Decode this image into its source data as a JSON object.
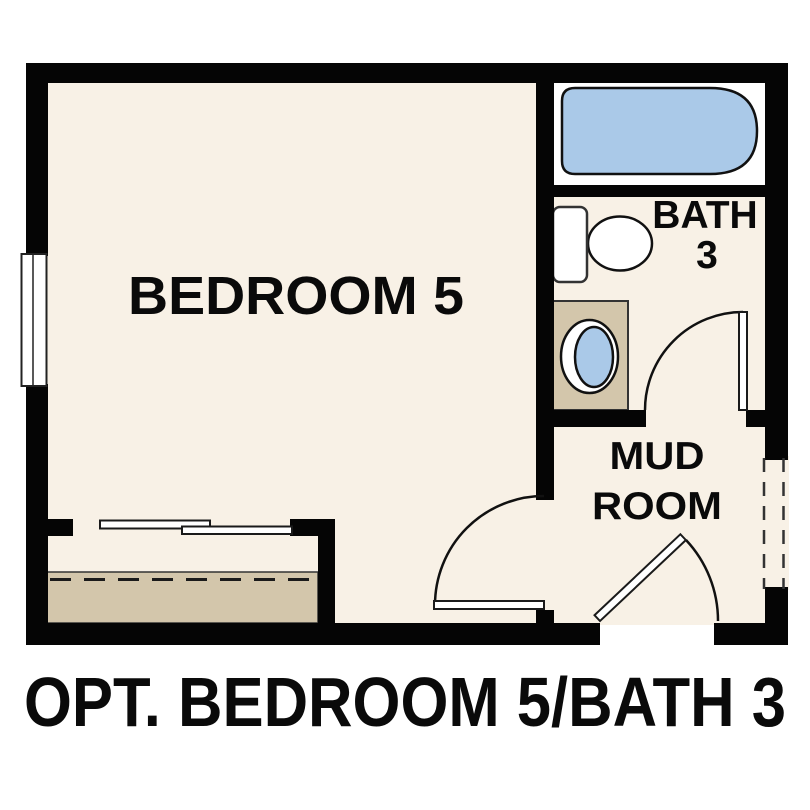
{
  "caption": "OPT. BEDROOM 5/BATH 3",
  "rooms": {
    "bedroom": {
      "label": "BEDROOM 5"
    },
    "bath": {
      "line1": "BATH",
      "line2": "3"
    },
    "mudroom": {
      "line1": "MUD",
      "line2": "ROOM"
    }
  },
  "colors": {
    "background": "#ffffff",
    "floor": "#f8f1e6",
    "wall": "#050505",
    "fixture_blue": "#aac9e8",
    "cabinet_tan": "#d3c6ab",
    "fixture_white": "#ffffff",
    "line_dark": "#1a1a1a"
  }
}
